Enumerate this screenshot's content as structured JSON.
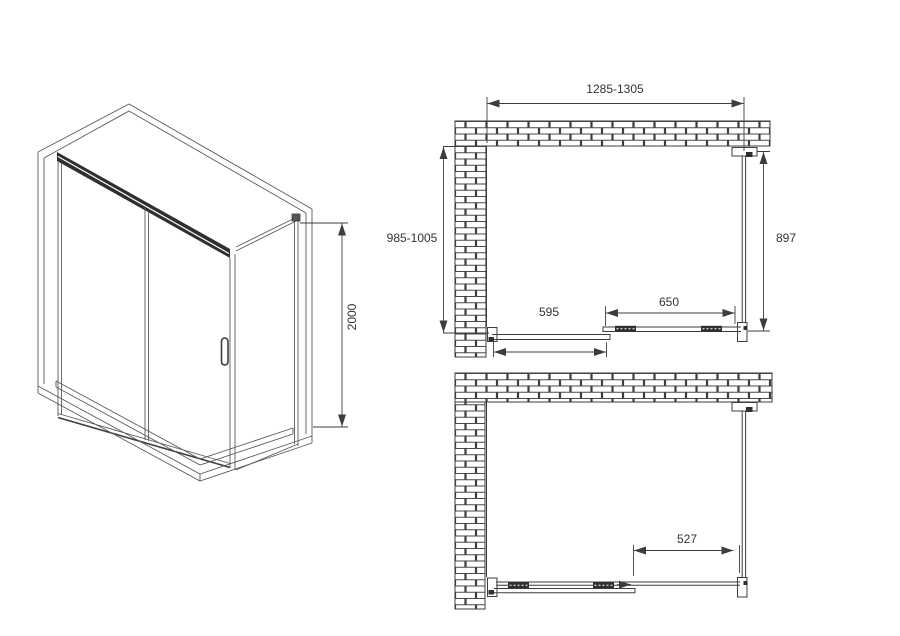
{
  "drawing": {
    "type": "shower-enclosure-technical-drawing",
    "views": {
      "perspective": "corner shower enclosure with sliding door, side panel and tray",
      "plan_top": "top view, door closed",
      "plan_bottom": "top view, door open"
    }
  },
  "dimensions": {
    "height": "2000",
    "overall_width_range": "1285-1305",
    "overall_depth_range": "985-1005",
    "side_panel_width": "897",
    "sliding_panel_width": "650",
    "fixed_panel_width": "595",
    "door_opening_width": "527"
  },
  "colors": {
    "background": "#ffffff",
    "line": "#3d3d3d",
    "thin_line": "#5a5a5a",
    "dark_fill": "#2f2f2f",
    "label_text": "#333333"
  }
}
